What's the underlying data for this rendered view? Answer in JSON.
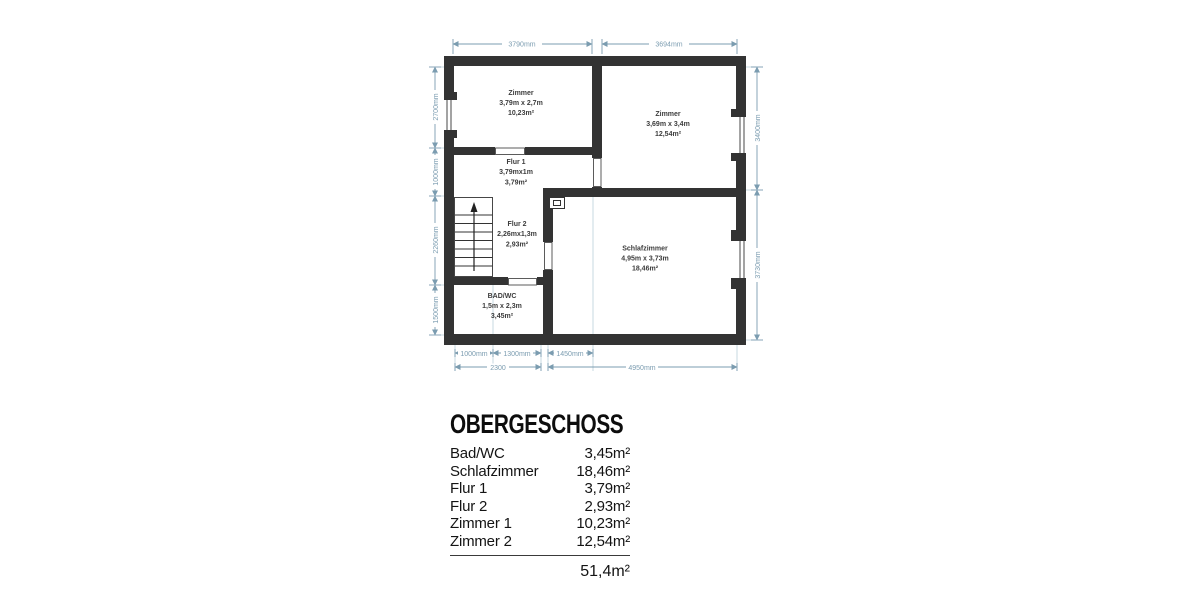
{
  "plan": {
    "rooms": [
      {
        "name": "Zimmer",
        "size": "3,79m x 2,7m",
        "area": "10,23m²"
      },
      {
        "name": "Zimmer",
        "size": "3,69m x 3,4m",
        "area": "12,54m²"
      },
      {
        "name": "Flur 1",
        "size": "3,79mx1m",
        "area": "3,79m²"
      },
      {
        "name": "Flur 2",
        "size": "2,26mx1,3m",
        "area": "2,93m²"
      },
      {
        "name": "Schlafzimmer",
        "size": "4,95m x 3,73m",
        "area": "18,46m²"
      },
      {
        "name": "BAD/WC",
        "size": "1,5m x 2,3m",
        "area": "3,45m²"
      }
    ],
    "dimensions": {
      "top": [
        "3790mm",
        "3694mm"
      ],
      "left": [
        "2700mm",
        "1000mm",
        "2260mm",
        "1500mm"
      ],
      "right": [
        "3400mm",
        "3730mm"
      ],
      "bottom_row1": [
        "1000mm",
        "1300mm",
        "1450mm"
      ],
      "bottom_row2": [
        "2300",
        "4950mm"
      ]
    },
    "colors": {
      "wall": "#333333",
      "dimension": "#7b9cb0",
      "room_text": "#3c3c3c"
    }
  },
  "legend": {
    "title": "OBERGESCHOSS",
    "items": [
      {
        "label": "Bad/WC",
        "area": "3,45m²"
      },
      {
        "label": "Schlafzimmer",
        "area": "18,46m²"
      },
      {
        "label": "Flur 1",
        "area": "3,79m²"
      },
      {
        "label": "Flur 2",
        "area": "2,93m²"
      },
      {
        "label": "Zimmer 1",
        "area": "10,23m²"
      },
      {
        "label": "Zimmer 2",
        "area": "12,54m²"
      }
    ],
    "total": "51,4m²"
  }
}
